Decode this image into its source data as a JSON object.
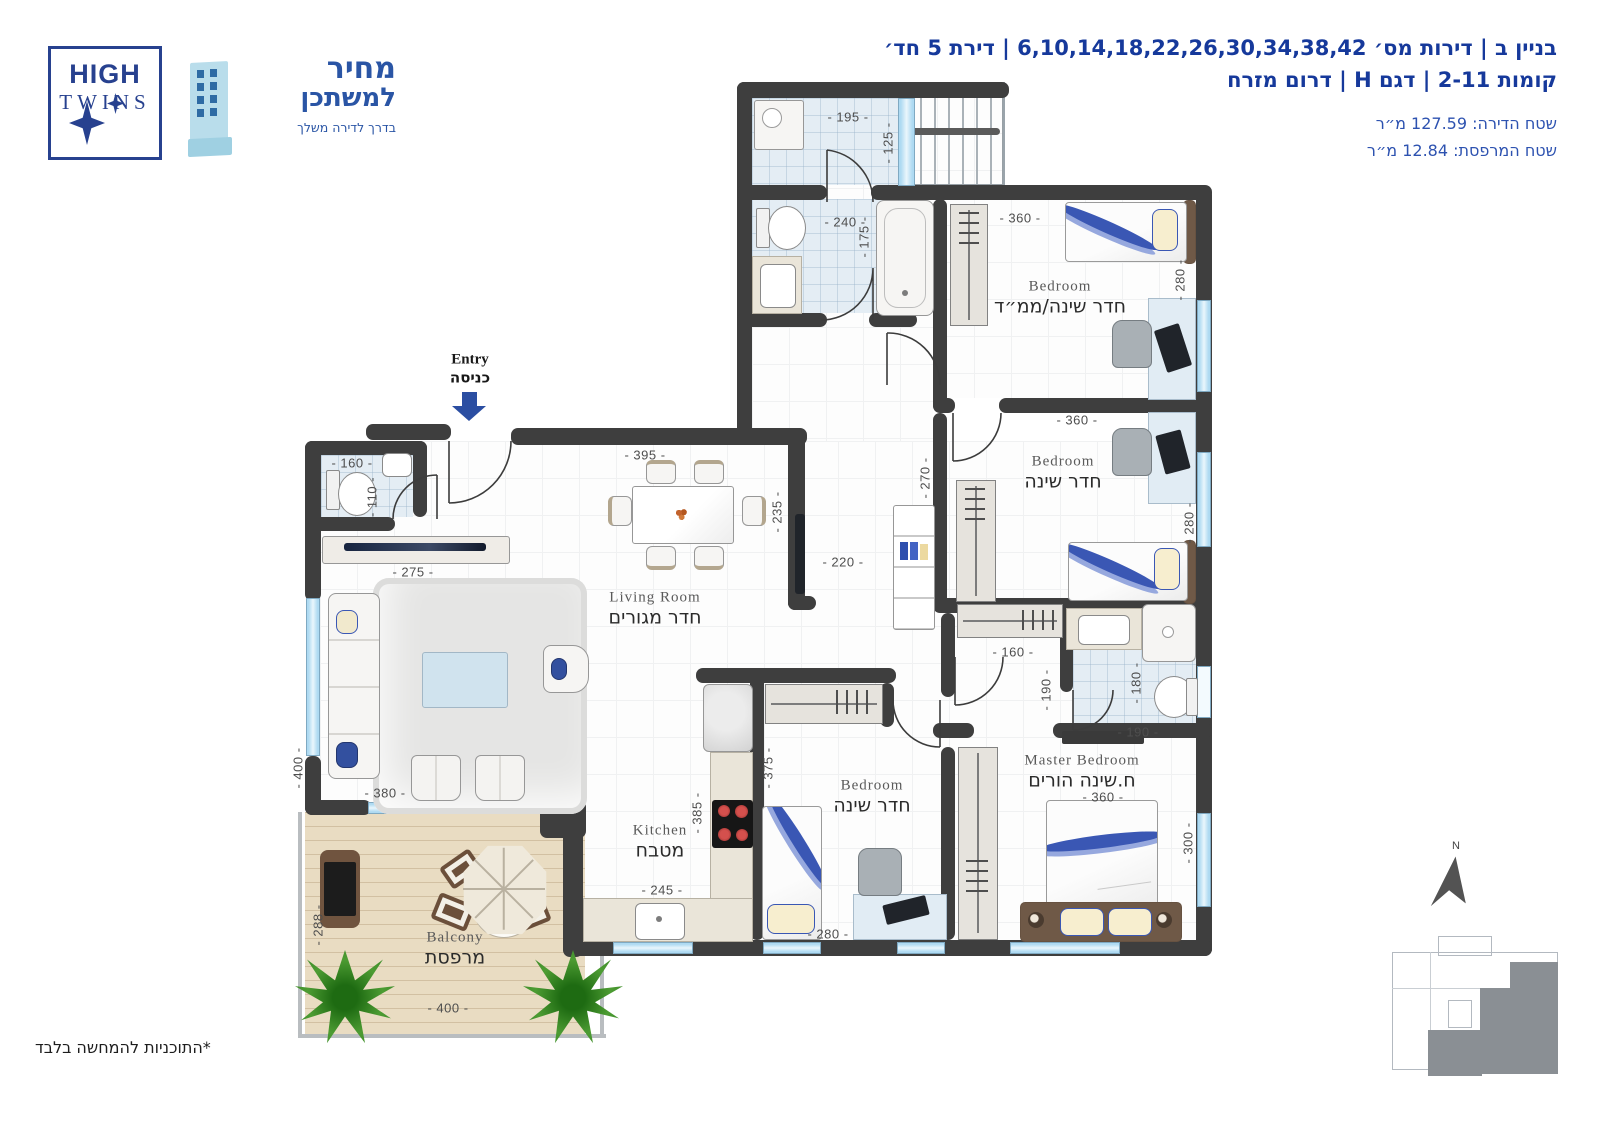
{
  "header": {
    "line1": "בניין ב | דירות מס׳ 6,10,14,18,22,26,30,34,38,42 | דירת 5 חד׳",
    "line2": "קומות 2-11 | דגם H | דרום מזרח",
    "area_apartment": "שטח הדירה: 127.59 מ״ר",
    "area_balcony": "שטח המרפסת: 12.84 מ״ר"
  },
  "logos": {
    "high": "HIGH",
    "twins": "TWINS",
    "mechir_line1": "מחיר",
    "mechir_line2": "למשתכן",
    "mechir_tagline": "בדרך לדירה משלך"
  },
  "rooms": {
    "living": {
      "en": "Living Room",
      "he": "חדר מגורים"
    },
    "kitchen": {
      "en": "Kitchen",
      "he": "מטבח"
    },
    "mamad": {
      "en": "Bedroom",
      "he": "חדר שינה/ממ״ד"
    },
    "bedroom2": {
      "en": "Bedroom",
      "he": "חדר שינה"
    },
    "bedroom3": {
      "en": "Bedroom",
      "he": "חדר שינה"
    },
    "master": {
      "en": "Master Bedroom",
      "he": "ח.שינה הורים"
    },
    "balcony": {
      "en": "Balcony",
      "he": "מרפסת"
    },
    "entry": {
      "en": "Entry",
      "he": "כניסה"
    }
  },
  "dims": {
    "s195": "- 195 -",
    "s125": "- 125 -",
    "b240": "- 240 -",
    "b175": "- 175 -",
    "m360": "- 360 -",
    "m280": "- 280 -",
    "b2_360": "- 360 -",
    "b2_280": "- 280 -",
    "h270": "- 270 -",
    "h220": "- 220 -",
    "c160": "- 160 -",
    "v190": "- 190 -",
    "v180": "- 180 -",
    "h190": "- 190 -",
    "ms360": "- 360 -",
    "ms300": "- 300 -",
    "b3_375": "- 375 -",
    "b3_280": "- 280 -",
    "k385": "- 385 -",
    "k245": "- 245 -",
    "l395": "- 395 -",
    "l235": "- 235 -",
    "l275": "- 275 -",
    "wc160": "- 160 -",
    "wc110": "- 110 -",
    "l380": "- 380 -",
    "l400": "- 400 -",
    "bal288": "- 288 -",
    "bal400": "- 400 -"
  },
  "compass": {
    "n": "N"
  },
  "footnote": "*התוכניות להמחשה בלבד",
  "colors": {
    "accent_blue": "#16399b",
    "wall": "#3e3e3e",
    "window": "#aedaf2",
    "deck": "#e9dcc2"
  }
}
